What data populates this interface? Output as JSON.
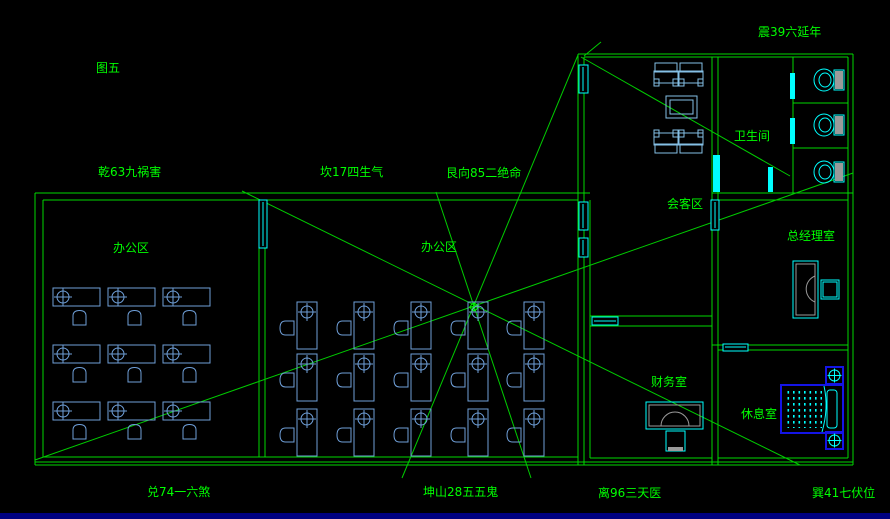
{
  "figure": {
    "caption": "图五"
  },
  "compass": {
    "top_left": "乾63九祸害",
    "top_center": "坎17四生气",
    "top_right": "艮向85二绝命",
    "upper_far_right": "震39六延年",
    "bottom_left": "兑74一六煞",
    "bottom_center": "坤山28五五鬼",
    "bottom_right": "离96三天医",
    "bottom_far_right": "巽41七伏位"
  },
  "rooms": {
    "office_left": "办公区",
    "office_middle": "办公区",
    "meeting_area": "会客区",
    "restroom": "卫生间",
    "gm_office": "总经理室",
    "finance_office": "财务室",
    "lounge": "休息室"
  },
  "colors": {
    "background": "#000000",
    "walls": "#00d900",
    "labels": "#00ff00",
    "fixtures": "#00ffff",
    "furniture": "#6f9fd8",
    "bed": "#1414e6",
    "status_bar": "#000080"
  }
}
